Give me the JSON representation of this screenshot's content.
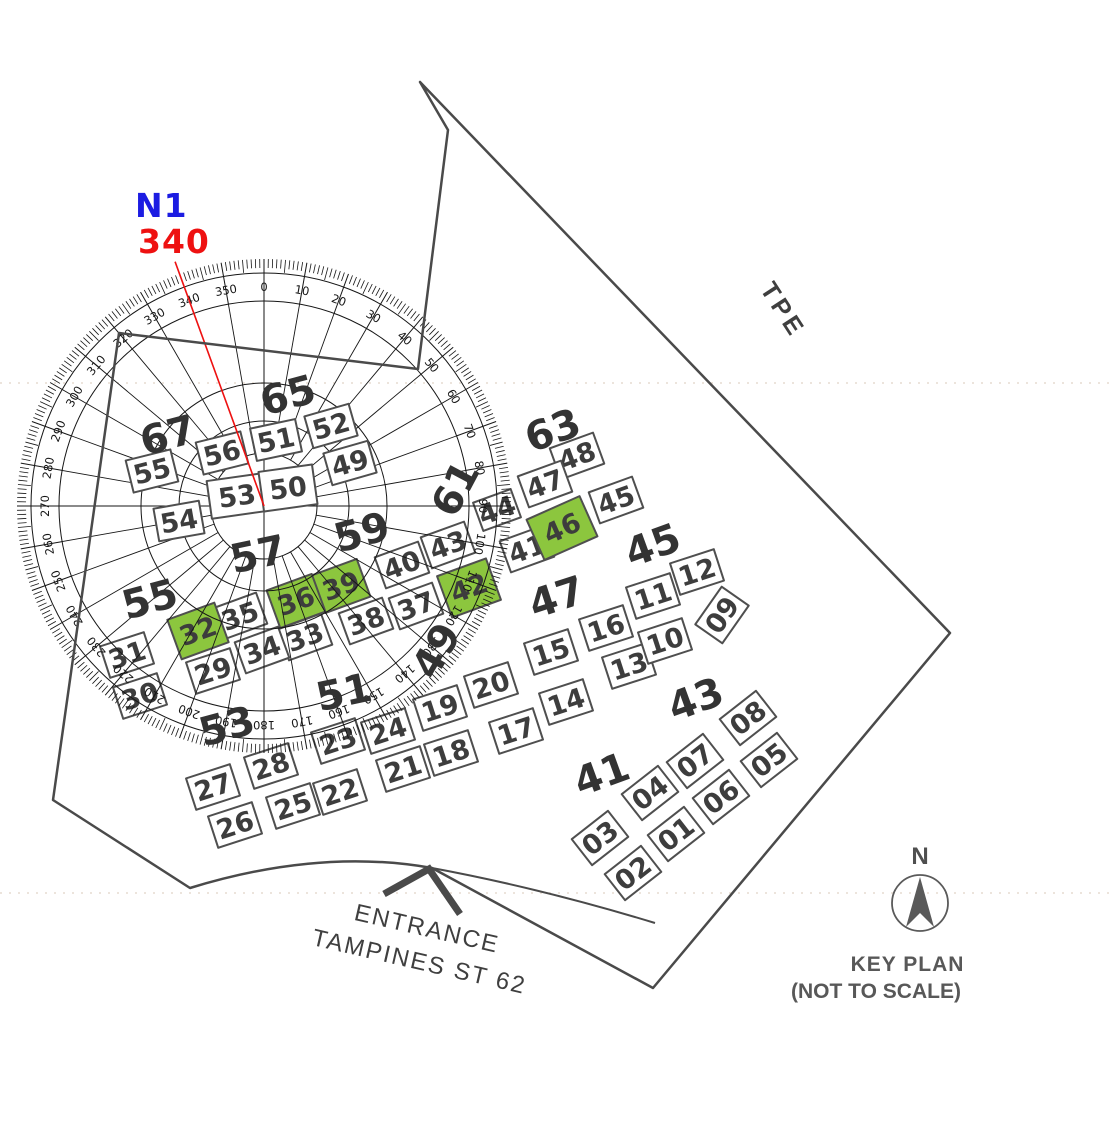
{
  "bearing": {
    "label": "N1",
    "value": "340",
    "deg": 340
  },
  "colors": {
    "blue": "#1c1ce2",
    "red": "#ee1111",
    "highlight": "#8cc63e",
    "boundary": "#4a4a4a",
    "compass": "#161616",
    "block_stroke": "#4f4f4f",
    "block_text": "#3d3d3d",
    "street_text": "#333333",
    "faint": "#ece4dc"
  },
  "roads": {
    "tpe": "TPE",
    "entrance_line1": "ENTRANCE",
    "entrance_line2": "TAMPINES ST 62"
  },
  "key_plan": {
    "north": "N",
    "line1": "KEY PLAN",
    "line2": "(NOT TO SCALE)"
  },
  "compass": {
    "cx": 264,
    "cy": 506,
    "bearing_deg": 340,
    "label_step": 10,
    "label_radius": 219,
    "circles": [
      53,
      85,
      123,
      205,
      233
    ],
    "tick_outer": 247,
    "faint_line_ys": [
      383,
      893
    ]
  },
  "highlighted_blocks": [
    "32",
    "36",
    "39",
    "42",
    "46"
  ],
  "street_labels": [
    {
      "t": "65",
      "x": 288,
      "y": 396,
      "r": -15
    },
    {
      "t": "67",
      "x": 168,
      "y": 436,
      "r": -15
    },
    {
      "t": "63",
      "x": 553,
      "y": 431,
      "r": -20
    },
    {
      "t": "61",
      "x": 456,
      "y": 489,
      "r": -62
    },
    {
      "t": "59",
      "x": 362,
      "y": 533,
      "r": -15
    },
    {
      "t": "57",
      "x": 258,
      "y": 555,
      "r": -12
    },
    {
      "t": "55",
      "x": 150,
      "y": 600,
      "r": -15
    },
    {
      "t": "53",
      "x": 227,
      "y": 727,
      "r": -15
    },
    {
      "t": "51",
      "x": 344,
      "y": 693,
      "r": -12
    },
    {
      "t": "49",
      "x": 437,
      "y": 651,
      "r": -60
    },
    {
      "t": "47",
      "x": 557,
      "y": 598,
      "r": -18
    },
    {
      "t": "45",
      "x": 653,
      "y": 546,
      "r": -20
    },
    {
      "t": "43",
      "x": 696,
      "y": 700,
      "r": -20
    },
    {
      "t": "41",
      "x": 602,
      "y": 775,
      "r": -20
    }
  ],
  "blocks": [
    {
      "n": "53",
      "x": 237,
      "y": 496,
      "r": -8,
      "w": 56,
      "h": 38,
      "inner": true
    },
    {
      "n": "50",
      "x": 288,
      "y": 488,
      "r": -8,
      "w": 54,
      "h": 40,
      "inner": true
    },
    {
      "n": "51",
      "x": 276,
      "y": 440,
      "r": -12,
      "inner": true
    },
    {
      "n": "56",
      "x": 222,
      "y": 453,
      "r": -14,
      "inner": true
    },
    {
      "n": "55",
      "x": 152,
      "y": 471,
      "r": -14,
      "inner": true
    },
    {
      "n": "54",
      "x": 179,
      "y": 521,
      "r": -10,
      "inner": true
    },
    {
      "n": "52",
      "x": 331,
      "y": 426,
      "r": -16,
      "inner": true
    },
    {
      "n": "49",
      "x": 350,
      "y": 463,
      "r": -16,
      "inner": true
    },
    {
      "n": "48",
      "x": 577,
      "y": 456,
      "r": -20
    },
    {
      "n": "47",
      "x": 545,
      "y": 484,
      "r": -20
    },
    {
      "n": "45",
      "x": 616,
      "y": 500,
      "r": -20
    },
    {
      "n": "44",
      "x": 497,
      "y": 510,
      "r": -20,
      "w": 40,
      "h": 30
    },
    {
      "n": "41",
      "x": 527,
      "y": 549,
      "r": -20
    },
    {
      "n": "46",
      "x": 562,
      "y": 528,
      "r": -24,
      "w": 58,
      "h": 44
    },
    {
      "n": "43",
      "x": 448,
      "y": 545,
      "r": -20
    },
    {
      "n": "40",
      "x": 402,
      "y": 565,
      "r": -20
    },
    {
      "n": "42",
      "x": 469,
      "y": 588,
      "r": -20,
      "w": 52,
      "h": 44
    },
    {
      "n": "39",
      "x": 341,
      "y": 586,
      "r": -20,
      "w": 48,
      "h": 40
    },
    {
      "n": "36",
      "x": 296,
      "y": 601,
      "r": -20,
      "w": 48,
      "h": 40
    },
    {
      "n": "38",
      "x": 366,
      "y": 621,
      "r": -20
    },
    {
      "n": "37",
      "x": 416,
      "y": 606,
      "r": -20
    },
    {
      "n": "35",
      "x": 240,
      "y": 616,
      "r": -20
    },
    {
      "n": "32",
      "x": 198,
      "y": 631,
      "r": -20,
      "w": 50,
      "h": 42
    },
    {
      "n": "33",
      "x": 305,
      "y": 637,
      "r": -20
    },
    {
      "n": "34",
      "x": 262,
      "y": 650,
      "r": -20
    },
    {
      "n": "29",
      "x": 213,
      "y": 671,
      "r": -18
    },
    {
      "n": "31",
      "x": 127,
      "y": 655,
      "r": -18
    },
    {
      "n": "30",
      "x": 140,
      "y": 696,
      "r": -18
    },
    {
      "n": "23",
      "x": 338,
      "y": 741,
      "r": -18
    },
    {
      "n": "24",
      "x": 388,
      "y": 731,
      "r": -18
    },
    {
      "n": "19",
      "x": 440,
      "y": 708,
      "r": -18
    },
    {
      "n": "20",
      "x": 491,
      "y": 685,
      "r": -18
    },
    {
      "n": "15",
      "x": 551,
      "y": 652,
      "r": -18
    },
    {
      "n": "16",
      "x": 606,
      "y": 628,
      "r": -18
    },
    {
      "n": "11",
      "x": 653,
      "y": 596,
      "r": -18
    },
    {
      "n": "12",
      "x": 697,
      "y": 572,
      "r": -18
    },
    {
      "n": "13",
      "x": 629,
      "y": 666,
      "r": -18
    },
    {
      "n": "10",
      "x": 665,
      "y": 641,
      "r": -18
    },
    {
      "n": "09",
      "x": 722,
      "y": 615,
      "r": -55
    },
    {
      "n": "14",
      "x": 566,
      "y": 702,
      "r": -18
    },
    {
      "n": "17",
      "x": 516,
      "y": 731,
      "r": -18
    },
    {
      "n": "18",
      "x": 451,
      "y": 753,
      "r": -18
    },
    {
      "n": "21",
      "x": 403,
      "y": 769,
      "r": -18
    },
    {
      "n": "22",
      "x": 340,
      "y": 792,
      "r": -18
    },
    {
      "n": "25",
      "x": 293,
      "y": 806,
      "r": -18
    },
    {
      "n": "26",
      "x": 235,
      "y": 825,
      "r": -18
    },
    {
      "n": "27",
      "x": 213,
      "y": 787,
      "r": -18
    },
    {
      "n": "28",
      "x": 271,
      "y": 766,
      "r": -18
    },
    {
      "n": "08",
      "x": 748,
      "y": 718,
      "r": -38
    },
    {
      "n": "07",
      "x": 695,
      "y": 761,
      "r": -38
    },
    {
      "n": "05",
      "x": 769,
      "y": 760,
      "r": -38
    },
    {
      "n": "04",
      "x": 650,
      "y": 793,
      "r": -38
    },
    {
      "n": "06",
      "x": 721,
      "y": 797,
      "r": -38
    },
    {
      "n": "03",
      "x": 600,
      "y": 838,
      "r": -38
    },
    {
      "n": "01",
      "x": 676,
      "y": 834,
      "r": -38
    },
    {
      "n": "02",
      "x": 633,
      "y": 873,
      "r": -38
    }
  ],
  "boundary": {
    "main_path": "M 420 82 L 448 130 L 418 369 L 119 333 L 53 800 L 190 888 Q 320 848 432 868 L 653 988 L 950 633 Z",
    "road_path": "M 432 868 Q 540 888 655 923"
  }
}
